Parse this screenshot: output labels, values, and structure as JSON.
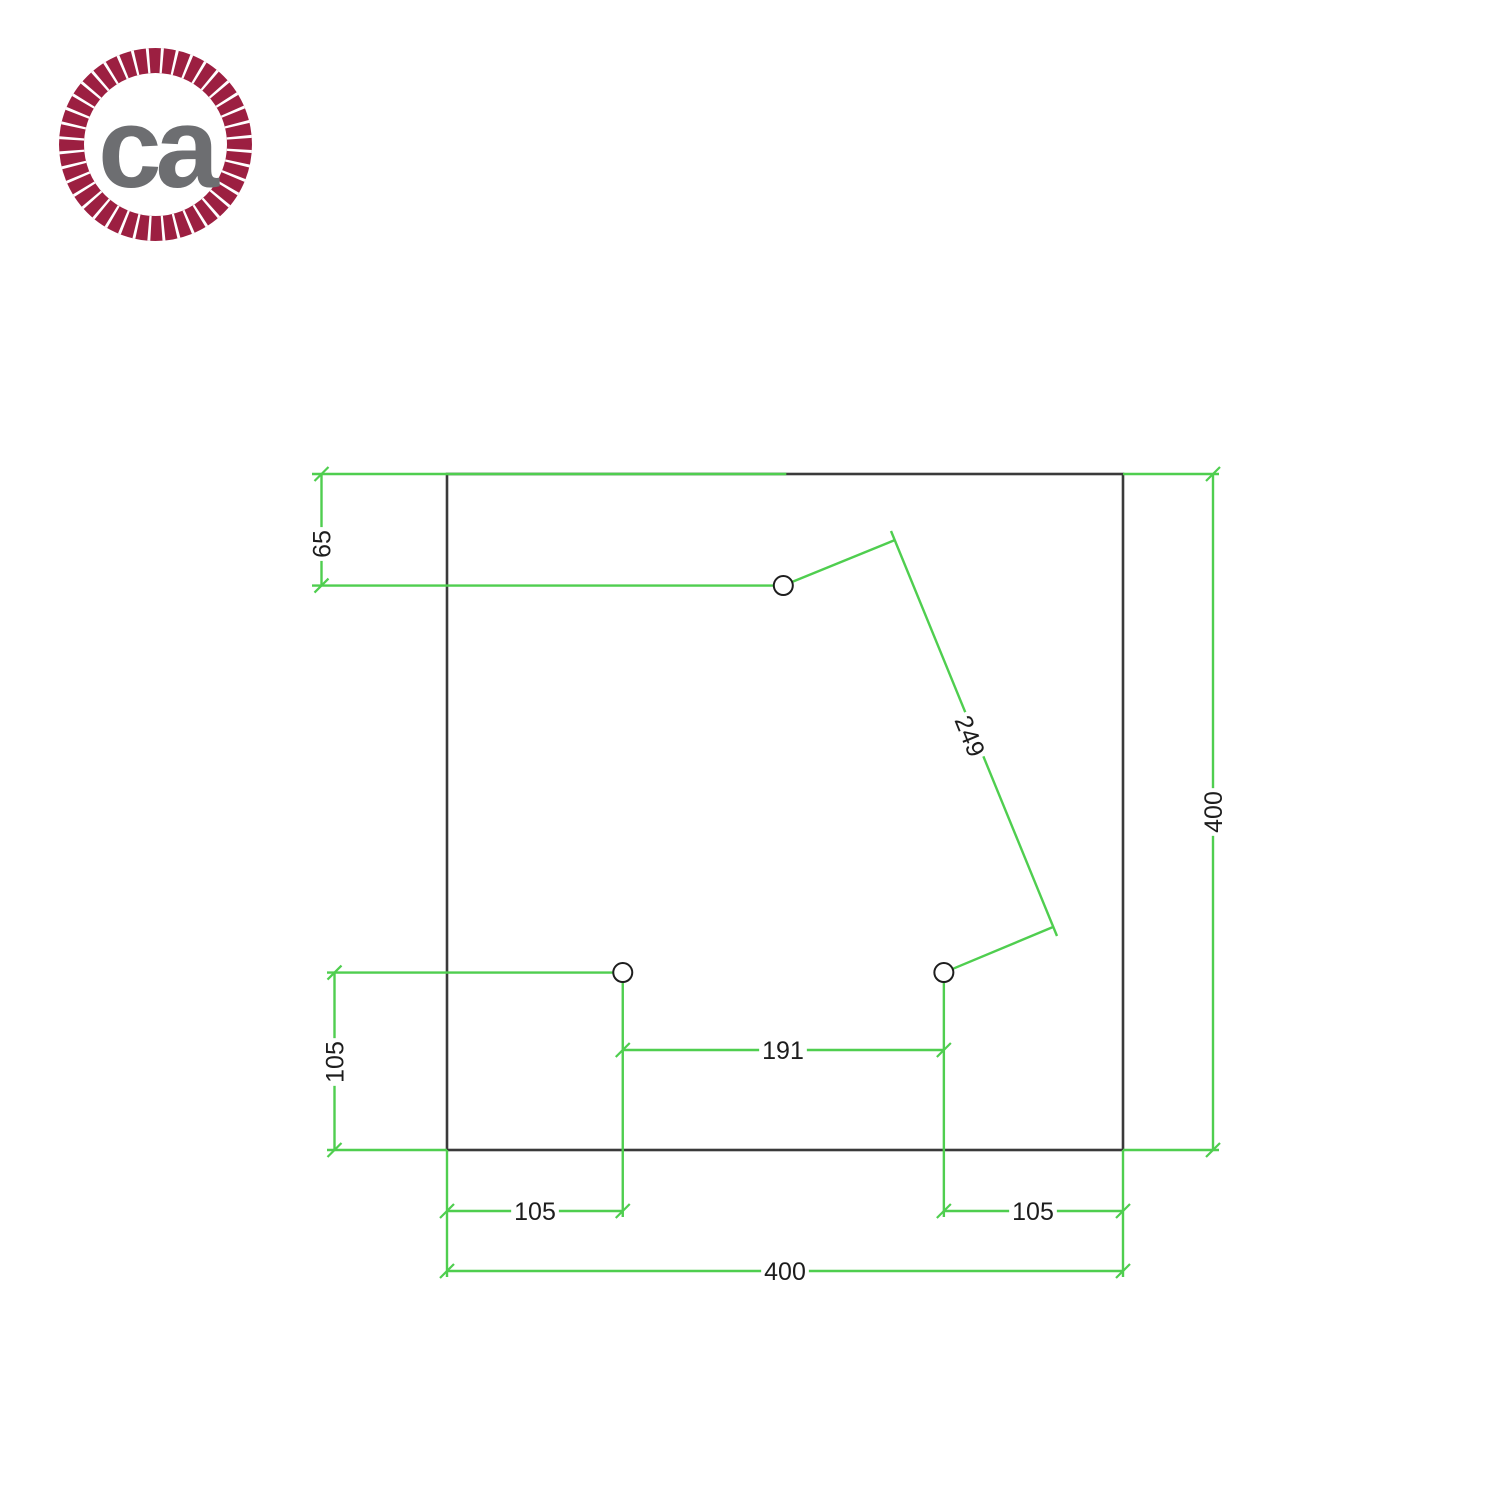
{
  "logo": {
    "text": "ca",
    "ring_color": "#9c1f41",
    "text_color": "#6d6e71"
  },
  "drawing": {
    "colors": {
      "outline": "#3a3a3a",
      "dimension_line": "#4fce4f",
      "dimension_text": "#1d1d1d",
      "hole_stroke": "#1e1e1e",
      "background": "#ffffff"
    },
    "plate": {
      "width_mm": 400,
      "height_mm": 400,
      "shape": "square"
    },
    "holes_mm": [
      {
        "id": "top",
        "x": 199,
        "y": 66
      },
      {
        "id": "bottom-left",
        "x": 104,
        "y": 295
      },
      {
        "id": "bottom-right",
        "x": 294,
        "y": 295
      }
    ],
    "dimensions": {
      "top_hole_offset": "65",
      "bottom_hole_offset": "105",
      "left_hole_from_left": "105",
      "right_hole_from_right": "105",
      "hole_spacing": "191",
      "hole_diagonal": "249",
      "plate_width": "400",
      "plate_height": "400"
    }
  }
}
